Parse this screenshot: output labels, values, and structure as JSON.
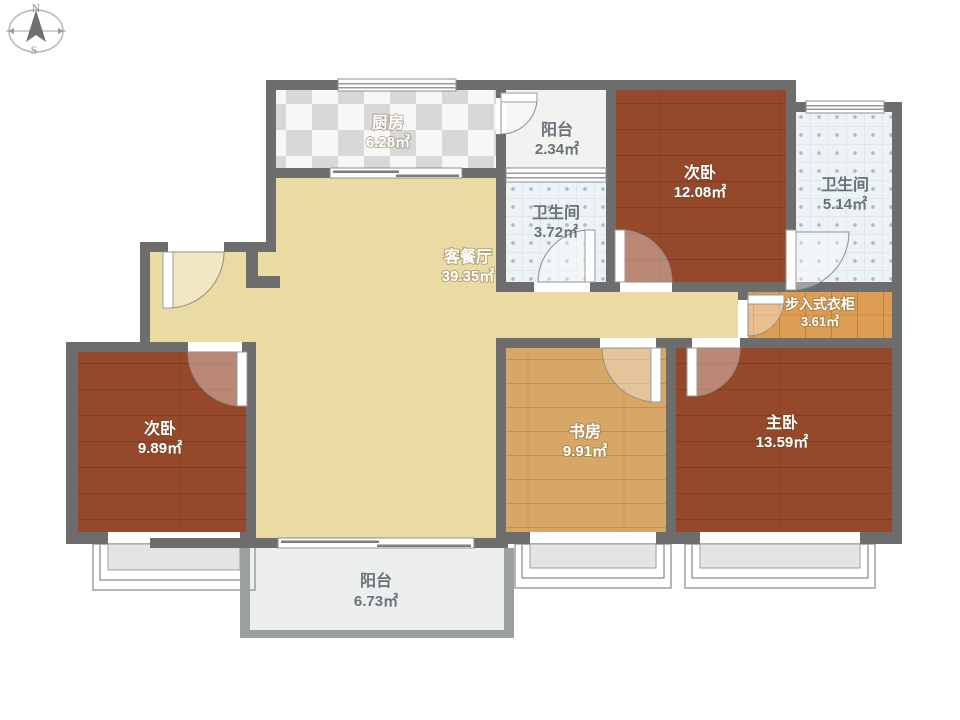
{
  "title": "apartment-floor-plan",
  "compass": {
    "north": "N",
    "south": "S"
  },
  "rooms": [
    {
      "id": "kitchen",
      "name": "厨房",
      "area": "6.28㎡"
    },
    {
      "id": "balcony-top",
      "name": "阳台",
      "area": "2.34㎡"
    },
    {
      "id": "bedroom-2",
      "name": "次卧",
      "area": "12.08㎡"
    },
    {
      "id": "bathroom-master",
      "name": "卫生间",
      "area": "5.14㎡"
    },
    {
      "id": "bathroom-guest",
      "name": "卫生间",
      "area": "3.72㎡"
    },
    {
      "id": "living-dining",
      "name": "客餐厅",
      "area": "39.35㎡"
    },
    {
      "id": "walk-in-closet",
      "name": "步入式衣柜",
      "area": "3.61㎡"
    },
    {
      "id": "bedroom-3",
      "name": "次卧",
      "area": "9.89㎡"
    },
    {
      "id": "study",
      "name": "书房",
      "area": "9.91㎡"
    },
    {
      "id": "master-bedroom",
      "name": "主卧",
      "area": "13.59㎡"
    },
    {
      "id": "balcony-bottom",
      "name": "阳台",
      "area": "6.73㎡"
    }
  ],
  "colors": {
    "wall": "#6d6d6d",
    "living_floor": "#eadaa4",
    "bedroom_floor": "#95492a",
    "kitchen_tile_dark": "#d8d8d8",
    "kitchen_tile_light": "#f7f7f7",
    "bath_tile": "#edf2f5",
    "bath_tile_dot": "#a6bacd",
    "study_wood": "#d6a766",
    "closet_wood": "#dd9d52",
    "balcony_floor": "#efefed",
    "label_on_dark": "#ffffff",
    "label_on_light": "#68727a"
  }
}
